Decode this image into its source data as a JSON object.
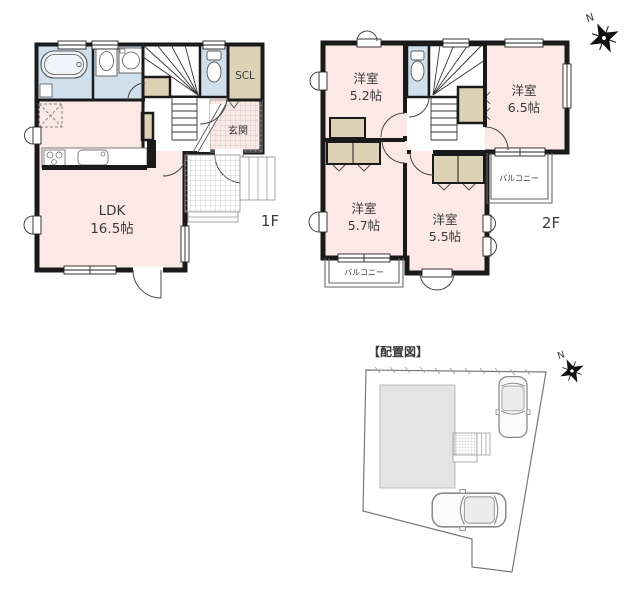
{
  "colors": {
    "wall": "#1a1a1a",
    "room_pink": "#fce9e5",
    "wet_blue": "#cfe0ec",
    "closet_tan": "#ddd2b6",
    "site_gray": "#e4e4e4",
    "label": "#3a3a3a"
  },
  "floor1": {
    "floor_label": "1F",
    "ldk": {
      "name": "LDK",
      "area": "16.5帖"
    },
    "scl_label": "SCL",
    "genkan_label": "玄関"
  },
  "floor2": {
    "floor_label": "2F",
    "compass_label": "N",
    "room_nw": {
      "name": "洋室",
      "area": "5.2帖"
    },
    "room_ne": {
      "name": "洋室",
      "area": "6.5帖"
    },
    "room_sw": {
      "name": "洋室",
      "area": "5.7帖"
    },
    "room_s": {
      "name": "洋室",
      "area": "5.5帖"
    },
    "balcony_east_label": "バルコニー",
    "balcony_south_label": "バルコニー"
  },
  "site": {
    "title": "【配置図】",
    "compass_label": "N"
  }
}
